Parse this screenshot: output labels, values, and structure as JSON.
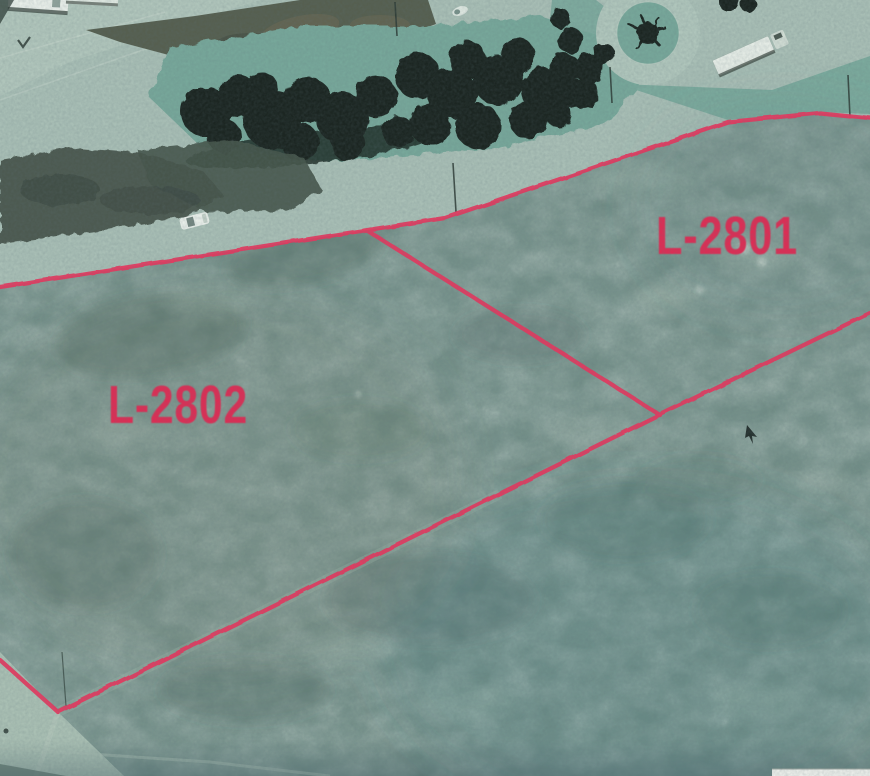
{
  "image": {
    "type": "scanned aerial photograph of vacant land parcels",
    "width": 870,
    "height": 776
  },
  "overlay": {
    "line_color": "#e5395f",
    "label_color": "#dc2d55",
    "stroke_width": 4.2,
    "boundaries": {
      "top": "0,287 445,218 728,122 820,113 870,118",
      "bottom_right": "870,313 655,417 58,712",
      "left_return": "58,712 0,660",
      "divider": "368,231 660,415"
    }
  },
  "parcels": [
    {
      "label": "L-2801",
      "x": 727,
      "y": 254,
      "text_length": 142,
      "font_size": 54
    },
    {
      "label": "L-2802",
      "x": 178,
      "y": 423,
      "text_length": 140,
      "font_size": 54
    }
  ],
  "photo": {
    "palette": {
      "scrub": "#6f8b84",
      "road": "#a8beb5",
      "road_ring": "#afc5bb",
      "road_bottom_left": "#a9bfb3",
      "grass": "#77a79a",
      "median_dirt": "#565f50",
      "trees": "#1d2823",
      "vehicle_white": "#e8eee9"
    }
  }
}
